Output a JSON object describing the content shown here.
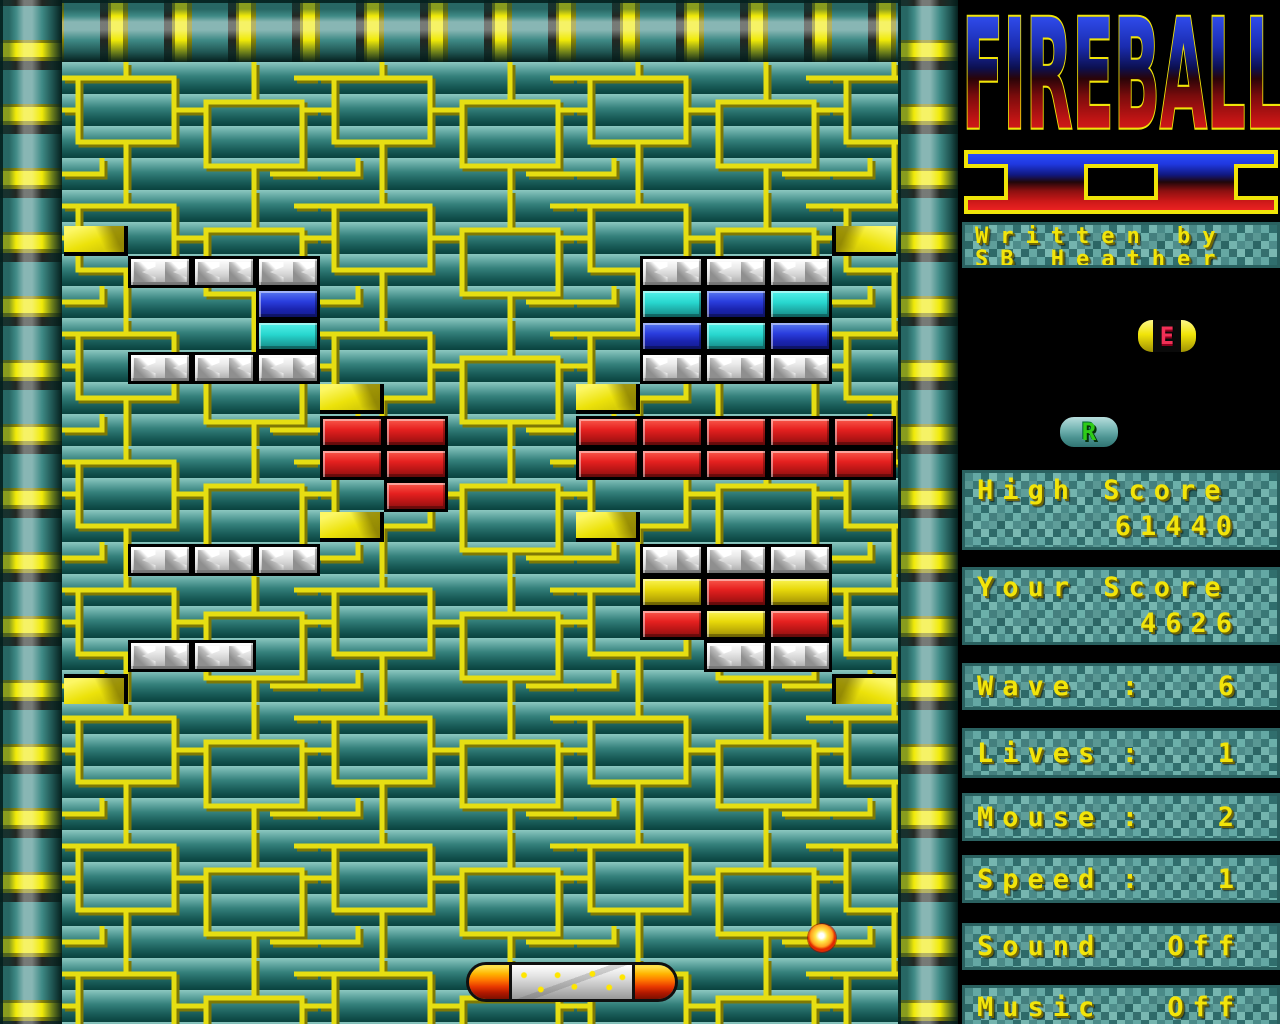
{
  "game": {
    "title_logo": "FIREBALL",
    "title_numeral": "II"
  },
  "sidebar": {
    "credit": {
      "line1": "Written by",
      "line2": "SB Heather"
    },
    "high_score": {
      "label": "High Score",
      "value": "61440"
    },
    "your_score": {
      "label": "Your Score",
      "value": "4626"
    },
    "stats": [
      {
        "id": "wave",
        "label": "Wave",
        "sep": ":",
        "value": "6",
        "y": 663,
        "h": 47
      },
      {
        "id": "lives",
        "label": "Lives",
        "sep": ":",
        "value": "1",
        "y": 728,
        "h": 50
      },
      {
        "id": "mouse",
        "label": "Mouse",
        "sep": ":",
        "value": "2",
        "y": 793,
        "h": 48
      },
      {
        "id": "speed",
        "label": "Speed",
        "sep": ":",
        "value": "1",
        "y": 855,
        "h": 48
      },
      {
        "id": "sound",
        "label": "Sound",
        "sep": "",
        "value": "Off",
        "y": 923,
        "h": 47
      },
      {
        "id": "music",
        "label": "Music",
        "sep": "",
        "value": "Off",
        "y": 985,
        "h": 44
      }
    ],
    "powerups": [
      {
        "letter": "E",
        "variant": "pill",
        "x": 1136,
        "y": 318,
        "w": 62,
        "h": 36
      },
      {
        "letter": "R",
        "variant": "teal",
        "x": 1058,
        "y": 415,
        "w": 62,
        "h": 34
      }
    ]
  },
  "colors": {
    "brick_white": "#e8e8e8",
    "brick_blue": "#2a3ede",
    "brick_cyan": "#27d6ce",
    "brick_red": "#e62120",
    "brick_yellow": "#e8d90a",
    "accent_yellow": "#f0ea08",
    "pipe_teal": "#3f8a86",
    "text_yellow": "#f2e40a"
  },
  "playfield": {
    "paddle": {
      "x": 466,
      "y": 962,
      "w": 212,
      "h": 40
    },
    "ball": {
      "x": 808,
      "y": 924,
      "d": 28
    },
    "bricks": [
      {
        "x": 128,
        "y": 256,
        "type": "white"
      },
      {
        "x": 192,
        "y": 256,
        "type": "white"
      },
      {
        "x": 256,
        "y": 256,
        "type": "white"
      },
      {
        "x": 256,
        "y": 288,
        "type": "blue"
      },
      {
        "x": 256,
        "y": 320,
        "type": "cyan"
      },
      {
        "x": 128,
        "y": 352,
        "type": "white"
      },
      {
        "x": 192,
        "y": 352,
        "type": "white"
      },
      {
        "x": 256,
        "y": 352,
        "type": "white"
      },
      {
        "x": 640,
        "y": 256,
        "type": "white"
      },
      {
        "x": 704,
        "y": 256,
        "type": "white"
      },
      {
        "x": 768,
        "y": 256,
        "type": "white"
      },
      {
        "x": 640,
        "y": 288,
        "type": "cyan"
      },
      {
        "x": 704,
        "y": 288,
        "type": "blue"
      },
      {
        "x": 768,
        "y": 288,
        "type": "cyan"
      },
      {
        "x": 640,
        "y": 320,
        "type": "blue"
      },
      {
        "x": 704,
        "y": 320,
        "type": "cyan"
      },
      {
        "x": 768,
        "y": 320,
        "type": "blue"
      },
      {
        "x": 640,
        "y": 352,
        "type": "white"
      },
      {
        "x": 704,
        "y": 352,
        "type": "white"
      },
      {
        "x": 768,
        "y": 352,
        "type": "white"
      },
      {
        "x": 320,
        "y": 416,
        "type": "red"
      },
      {
        "x": 384,
        "y": 416,
        "type": "red"
      },
      {
        "x": 320,
        "y": 448,
        "type": "red"
      },
      {
        "x": 384,
        "y": 448,
        "type": "red"
      },
      {
        "x": 384,
        "y": 480,
        "type": "red"
      },
      {
        "x": 576,
        "y": 416,
        "type": "red"
      },
      {
        "x": 640,
        "y": 416,
        "type": "red"
      },
      {
        "x": 704,
        "y": 416,
        "type": "red"
      },
      {
        "x": 768,
        "y": 416,
        "type": "red"
      },
      {
        "x": 832,
        "y": 416,
        "type": "red"
      },
      {
        "x": 576,
        "y": 448,
        "type": "red"
      },
      {
        "x": 640,
        "y": 448,
        "type": "red"
      },
      {
        "x": 704,
        "y": 448,
        "type": "red"
      },
      {
        "x": 768,
        "y": 448,
        "type": "red"
      },
      {
        "x": 832,
        "y": 448,
        "type": "red"
      },
      {
        "x": 128,
        "y": 544,
        "type": "white"
      },
      {
        "x": 192,
        "y": 544,
        "type": "white"
      },
      {
        "x": 256,
        "y": 544,
        "type": "white"
      },
      {
        "x": 640,
        "y": 544,
        "type": "white"
      },
      {
        "x": 704,
        "y": 544,
        "type": "white"
      },
      {
        "x": 768,
        "y": 544,
        "type": "white"
      },
      {
        "x": 640,
        "y": 576,
        "type": "yellow"
      },
      {
        "x": 704,
        "y": 576,
        "type": "red"
      },
      {
        "x": 768,
        "y": 576,
        "type": "yellow"
      },
      {
        "x": 640,
        "y": 608,
        "type": "red"
      },
      {
        "x": 704,
        "y": 608,
        "type": "yellow"
      },
      {
        "x": 768,
        "y": 608,
        "type": "red"
      },
      {
        "x": 704,
        "y": 640,
        "type": "white"
      },
      {
        "x": 768,
        "y": 640,
        "type": "white"
      },
      {
        "x": 128,
        "y": 640,
        "type": "white"
      },
      {
        "x": 192,
        "y": 640,
        "type": "white"
      }
    ],
    "wedges": [
      {
        "x": 64,
        "y": 226,
        "face": "right",
        "edge": "rb"
      },
      {
        "x": 832,
        "y": 226,
        "face": "left",
        "edge": "lb"
      },
      {
        "x": 320,
        "y": 384,
        "face": "right",
        "edge": "rb"
      },
      {
        "x": 576,
        "y": 384,
        "face": "right",
        "edge": "rb"
      },
      {
        "x": 320,
        "y": 512,
        "face": "right",
        "edge": "rb"
      },
      {
        "x": 576,
        "y": 512,
        "face": "right",
        "edge": "rb"
      },
      {
        "x": 64,
        "y": 674,
        "face": "right",
        "edge": "rt"
      },
      {
        "x": 832,
        "y": 674,
        "face": "left",
        "edge": "lt"
      }
    ]
  }
}
